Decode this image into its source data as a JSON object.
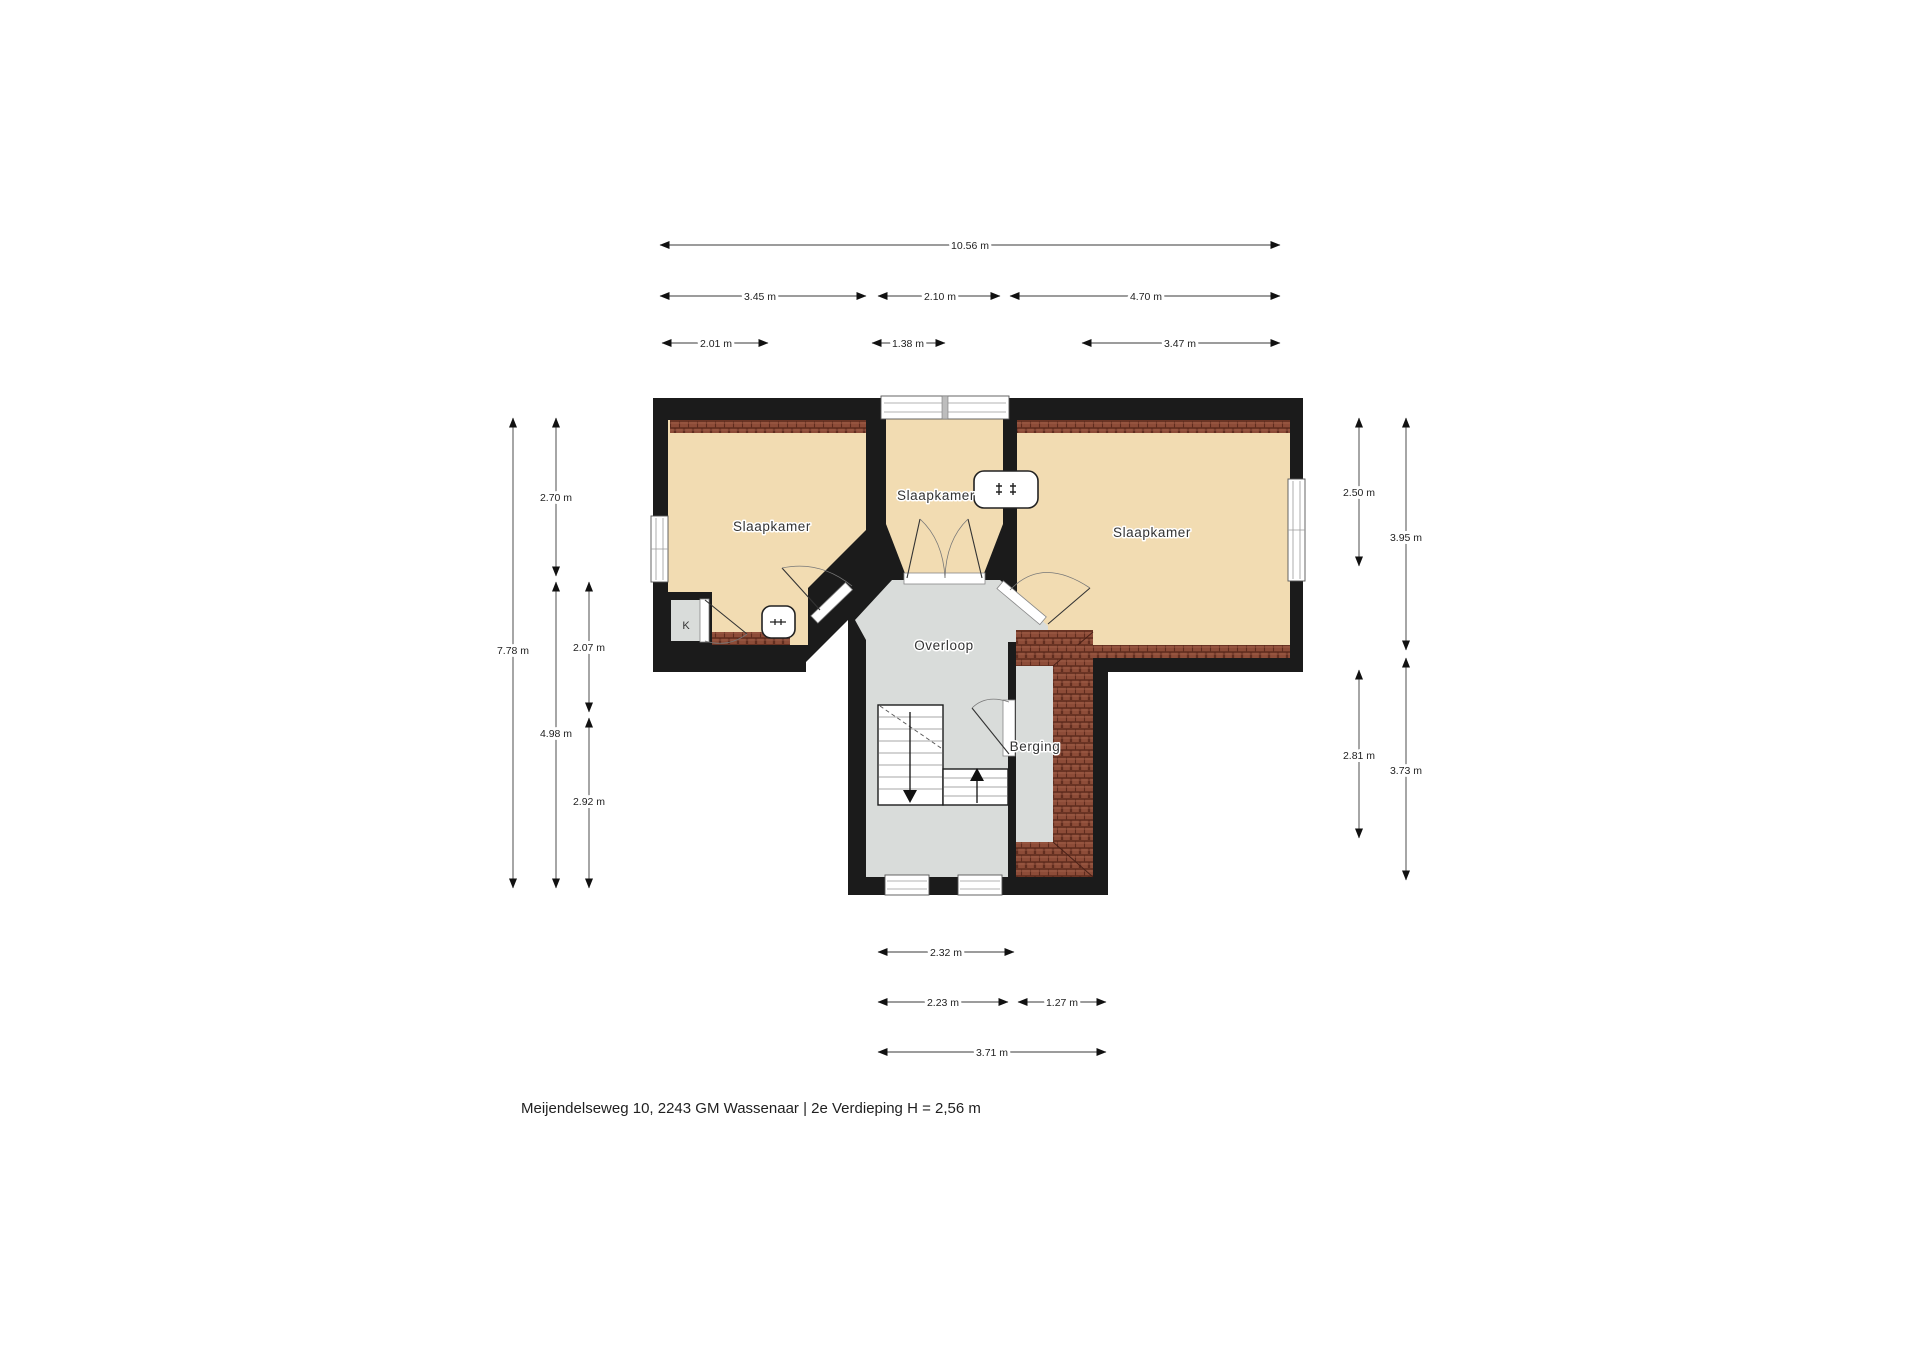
{
  "caption": "Meijendelseweg 10, 2243 GM Wassenaar | 2e Verdieping H = 2,56 m",
  "rooms": [
    {
      "name": "slaapkamer-left",
      "label": "Slaapkamer"
    },
    {
      "name": "slaapkamer-middle",
      "label": "Slaapkamer"
    },
    {
      "name": "slaapkamer-right",
      "label": "Slaapkamer"
    },
    {
      "name": "overloop",
      "label": "Overloop"
    },
    {
      "name": "berging",
      "label": "Berging"
    },
    {
      "name": "kast",
      "label": "K"
    }
  ],
  "dims": [
    {
      "name": "total-width",
      "label": "10.56 m"
    },
    {
      "name": "width-left",
      "label": "3.45 m"
    },
    {
      "name": "width-middle",
      "label": "2.10 m"
    },
    {
      "name": "width-right",
      "label": "4.70 m"
    },
    {
      "name": "inner-width-left",
      "label": "2.01 m"
    },
    {
      "name": "inner-width-middle",
      "label": "1.38 m"
    },
    {
      "name": "inner-width-right",
      "label": "3.47 m"
    },
    {
      "name": "total-height-left",
      "label": "7.78 m"
    },
    {
      "name": "height-left-top",
      "label": "2.70 m"
    },
    {
      "name": "height-left-mid",
      "label": "2.07 m"
    },
    {
      "name": "height-left-lower",
      "label": "4.98 m"
    },
    {
      "name": "height-left-bottom",
      "label": "2.92 m"
    },
    {
      "name": "height-right-top",
      "label": "2.50 m"
    },
    {
      "name": "height-right-upper",
      "label": "3.95 m"
    },
    {
      "name": "height-right-lower",
      "label": "2.81 m"
    },
    {
      "name": "height-right-bottom",
      "label": "3.73 m"
    },
    {
      "name": "ext-width-top",
      "label": "2.32 m"
    },
    {
      "name": "ext-width-stair",
      "label": "2.23 m"
    },
    {
      "name": "ext-width-berging",
      "label": "1.27 m"
    },
    {
      "name": "ext-width-total",
      "label": "3.71 m"
    }
  ],
  "colors": {
    "wall": "#1b1b1b",
    "floor_tan": "#f2dcb2",
    "floor_gray": "#d9dcda",
    "roof_tile": "#8d4c38",
    "roof_tile_line": "#5f2c1e",
    "dim_line": "#3a3a3a"
  }
}
